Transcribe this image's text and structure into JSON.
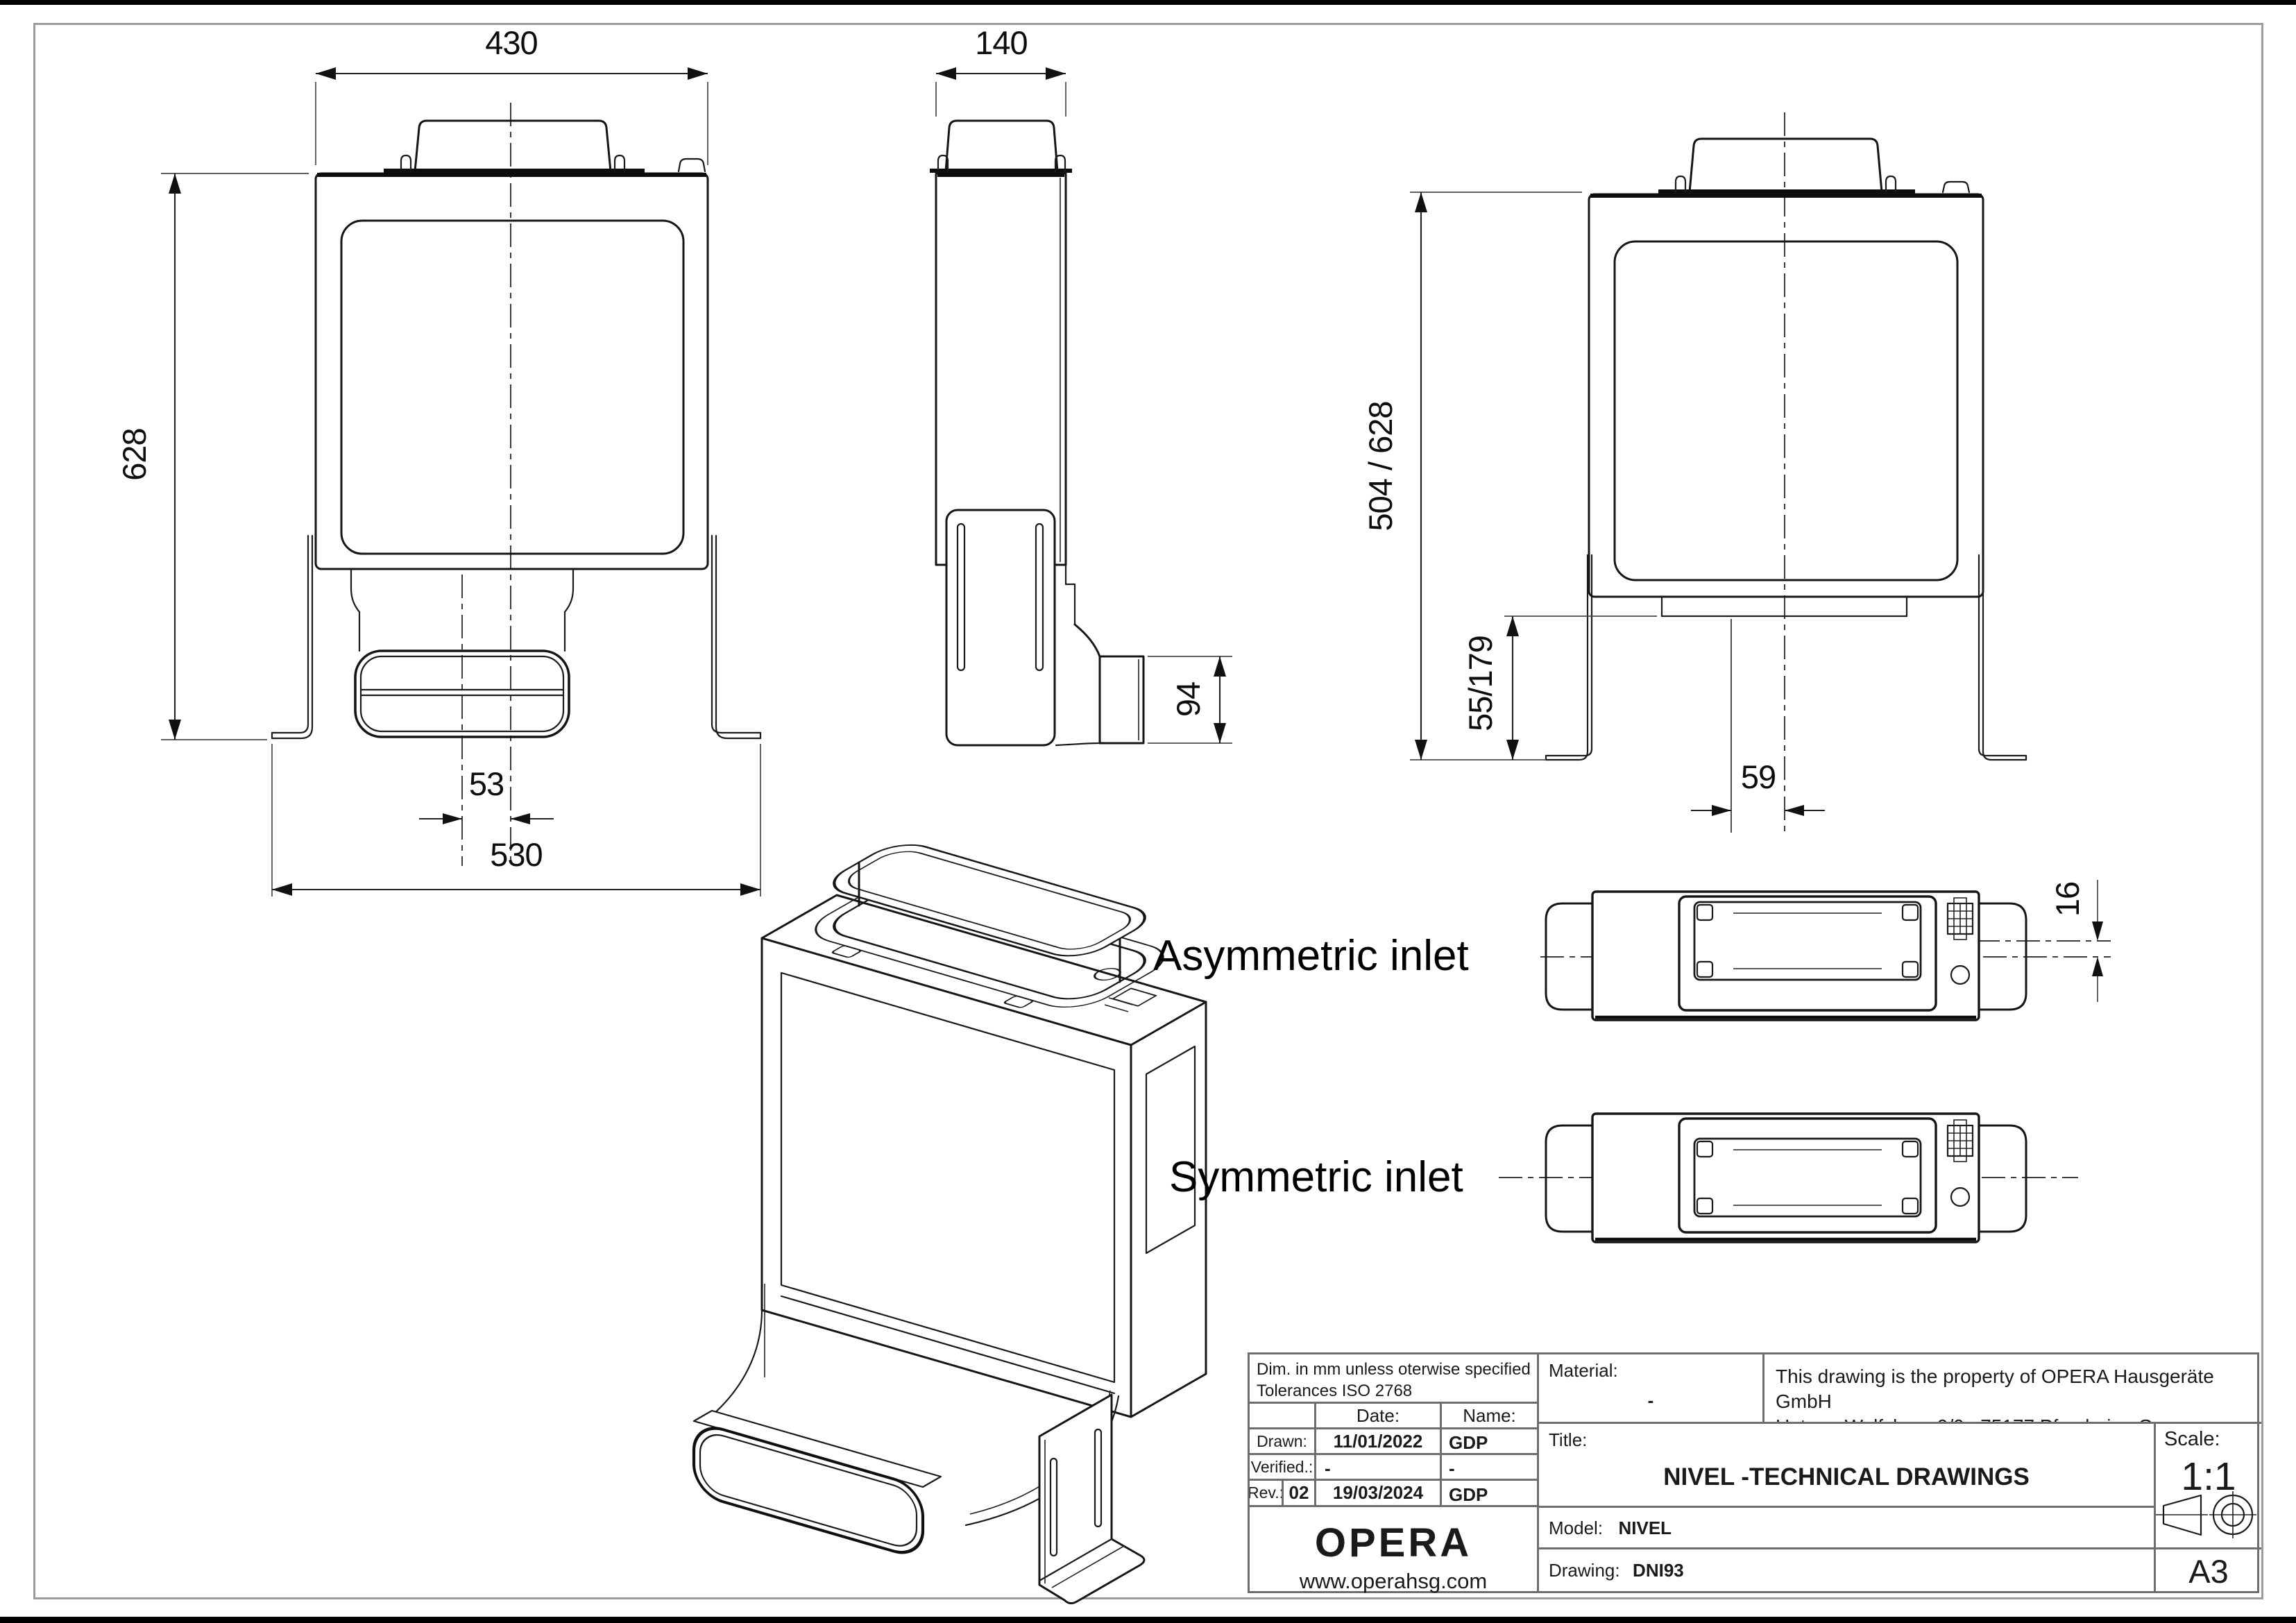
{
  "views": {
    "front_view": {
      "dim_top": "430",
      "dim_height": "628",
      "dim_offset": "53",
      "dim_bottom": "530"
    },
    "side_view": {
      "dim_depth": "140",
      "dim_outlet": "94"
    },
    "back_view": {
      "dim_height": "504 / 628",
      "dim_bracket": "55/179",
      "dim_offset": "59"
    },
    "inlet_views": {
      "asym_label": "Asymmetric inlet",
      "sym_label": "Symmetric inlet",
      "dim_offset": "16"
    }
  },
  "title_block": {
    "note_line1": "Dim. in mm unless oterwise specified",
    "note_line2": "Tolerances ISO 2768",
    "date_header": "Date:",
    "name_header": "Name:",
    "drawn_label": "Drawn:",
    "drawn_date": "11/01/2022",
    "drawn_name": "GDP",
    "verified_label": "Verified.:",
    "verified_date": "-",
    "verified_name": "-",
    "rev_label": "Rev.:",
    "rev_number": "02",
    "rev_date": "19/03/2024",
    "rev_name": "GDP",
    "logo_text": "OPERA",
    "website": "www.operahsg.com",
    "material_label": "Material:",
    "material_value": "-",
    "property_line1": "This drawing is the property of OPERA Hausgeräte GmbH",
    "property_line2": "Unterm Wolfsberg 9/9a 75177 Pforzheim, Germany",
    "title_label": "Title:",
    "title_value": "NIVEL -TECHNICAL DRAWINGS",
    "model_label": "Model:",
    "model_value": "NIVEL",
    "drawing_label": "Drawing:",
    "drawing_value": "DNI93",
    "scale_label": "Scale:",
    "scale_value": "1:1",
    "sheet_size": "A3"
  }
}
